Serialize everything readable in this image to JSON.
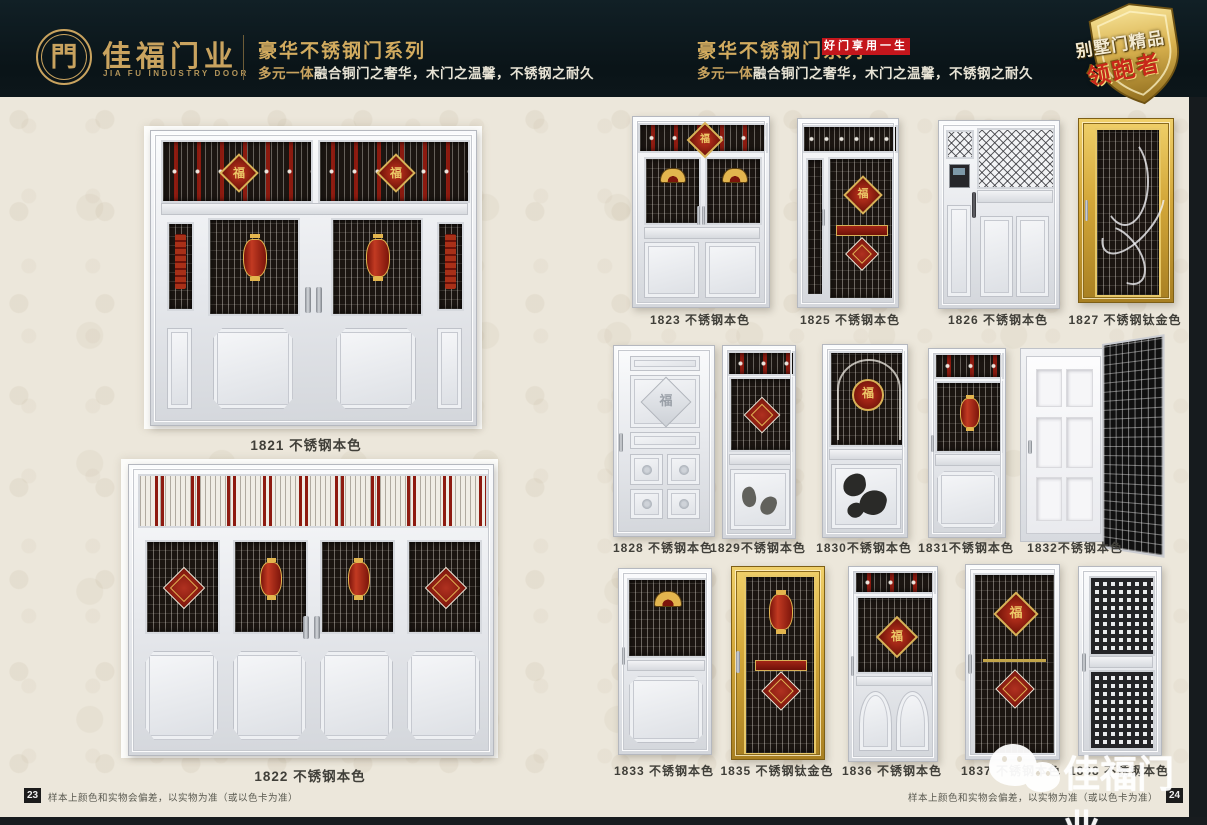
{
  "header": {
    "logo": {
      "glyph": "門",
      "brand": "佳福门业",
      "brand_en": "JIA FU INDUSTRY DOOR"
    },
    "left": {
      "series_title": "豪华不锈钢门系列",
      "tagline_highlight": "多元一体",
      "tagline_rest": "融合铜门之奢华，木门之温馨，不锈钢之耐久"
    },
    "right": {
      "series_title": "豪华不锈钢门系列",
      "slogan_badge": "好门享用一生",
      "tagline_highlight": "多元一体",
      "tagline_rest": "融合铜门之奢华，木门之温馨，不锈钢之耐久"
    },
    "award_badge": {
      "line1": "别墅门精品",
      "line2": "领跑者"
    }
  },
  "left_page": {
    "doors": [
      {
        "model": "1821",
        "finish": "不锈钢本色",
        "label": "1821 不锈钢本色"
      },
      {
        "model": "1822",
        "finish": "不锈钢本色",
        "label": "1822 不锈钢本色"
      }
    ],
    "page_number": "23",
    "disclaimer": "样本上颜色和实物会偏差，以实物为准（或以色卡为准）"
  },
  "right_page": {
    "rows": [
      {
        "doors": [
          {
            "model": "1823",
            "finish": "不锈钢本色",
            "label": "1823 不锈钢本色"
          },
          {
            "model": "1825",
            "finish": "不锈钢本色",
            "label": "1825 不锈钢本色"
          },
          {
            "model": "1826",
            "finish": "不锈钢本色",
            "label": "1826 不锈钢本色"
          },
          {
            "model": "1827",
            "finish": "不锈钢钛金色",
            "label": "1827 不锈钢钛金色"
          }
        ]
      },
      {
        "doors": [
          {
            "model": "1828",
            "finish": "不锈钢本色",
            "label": "1828 不锈钢本色"
          },
          {
            "model": "1829",
            "finish": "不锈钢本色",
            "label": "1829不锈钢本色"
          },
          {
            "model": "1830",
            "finish": "不锈钢本色",
            "label": "1830不锈钢本色"
          },
          {
            "model": "1831",
            "finish": "不锈钢本色",
            "label": "1831不锈钢本色"
          },
          {
            "model": "1832",
            "finish": "不锈钢本色",
            "label": "1832不锈钢本色"
          }
        ]
      },
      {
        "doors": [
          {
            "model": "1833",
            "finish": "不锈钢本色",
            "label": "1833 不锈钢本色"
          },
          {
            "model": "1835",
            "finish": "不锈钢钛金色",
            "label": "1835 不锈钢钛金色"
          },
          {
            "model": "1836",
            "finish": "不锈钢本色",
            "label": "1836 不锈钢本色"
          },
          {
            "model": "1837",
            "finish": "不锈钢本色",
            "label": "1837 不锈钢本色"
          },
          {
            "model": "1838",
            "finish": "不锈钢本色",
            "label": "1838 不锈钢本色"
          }
        ]
      }
    ],
    "page_number": "24",
    "disclaimer": "样本上颜色和实物会偏差，以实物为准（或以色卡为准）"
  },
  "watermark": {
    "icon": "wechat-icon",
    "brand": "佳福门业"
  },
  "colors": {
    "header_bg": "#0c161a",
    "gold": "#c9a35f",
    "red_badge": "#c4161c",
    "cream_bg": "#ece7db",
    "dark_window": "#1b1511",
    "accent_red": "#8e1a10",
    "accent_gold": "#d9b257",
    "titanium_gold": "#d3a739",
    "page_number_bg": "#1c1c1c",
    "label_text": "#403f39"
  }
}
